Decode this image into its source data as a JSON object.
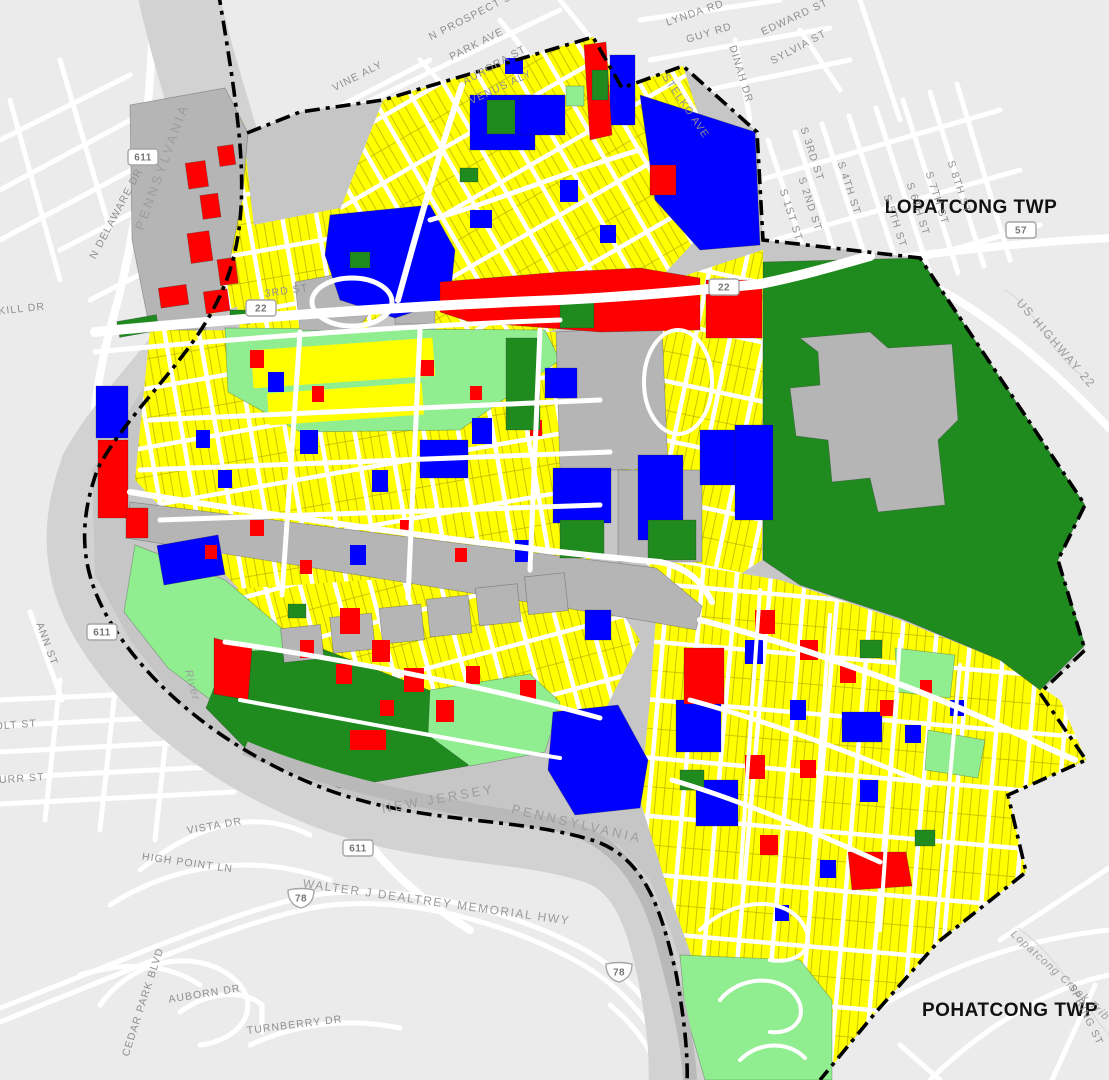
{
  "map": {
    "townships": [
      {
        "t": "LOPATCONG TWP",
        "x": 971,
        "y": 213,
        "r": 0,
        "c": "tw"
      },
      {
        "t": "POHATCONG TWP",
        "x": 1010,
        "y": 1016,
        "r": 0,
        "c": "tw"
      }
    ],
    "state_labels": [
      {
        "t": "PENNSYLVANIA",
        "x": 166,
        "y": 168,
        "r": -70,
        "c": "sta"
      },
      {
        "t": "NEW JERSEY",
        "x": 439,
        "y": 803,
        "r": -10,
        "c": "sta"
      },
      {
        "t": "PENNSYLVANIA",
        "x": 576,
        "y": 828,
        "r": 13,
        "c": "sta"
      }
    ],
    "water_labels": [
      {
        "t": "Lopatcong Creek Trib",
        "x": 1058,
        "y": 978,
        "r": 42,
        "c": "wat"
      },
      {
        "t": "River",
        "x": 189,
        "y": 686,
        "r": 75,
        "c": "wat"
      }
    ],
    "street_labels": [
      {
        "t": "N PROSPECT ST",
        "x": 475,
        "y": 18,
        "r": -27,
        "c": "st"
      },
      {
        "t": "PARK AVE",
        "x": 478,
        "y": 47,
        "r": -27,
        "c": "st"
      },
      {
        "t": "AURORA ST",
        "x": 496,
        "y": 68,
        "r": -29,
        "c": "st"
      },
      {
        "t": "VENUS ALY",
        "x": 502,
        "y": 90,
        "r": -25,
        "c": "st"
      },
      {
        "t": "VINE ALY",
        "x": 359,
        "y": 79,
        "r": -27,
        "c": "st"
      },
      {
        "t": "LYNDA RD",
        "x": 696,
        "y": 16,
        "r": -19,
        "c": "st"
      },
      {
        "t": "GUY RD",
        "x": 710,
        "y": 36,
        "r": -17,
        "c": "st"
      },
      {
        "t": "EDWARD ST",
        "x": 796,
        "y": 20,
        "r": -25,
        "c": "st"
      },
      {
        "t": "SYLVIA ST",
        "x": 800,
        "y": 50,
        "r": -28,
        "c": "st"
      },
      {
        "t": "DINAH DR",
        "x": 738,
        "y": 75,
        "r": 73,
        "c": "st"
      },
      {
        "t": "STELKO AVE",
        "x": 683,
        "y": 108,
        "r": 56,
        "c": "st"
      },
      {
        "t": "S 1ST ST",
        "x": 788,
        "y": 216,
        "r": 72,
        "c": "st"
      },
      {
        "t": "S 2ND ST",
        "x": 807,
        "y": 205,
        "r": 72,
        "c": "st"
      },
      {
        "t": "S 3RD ST",
        "x": 809,
        "y": 155,
        "r": 72,
        "c": "st"
      },
      {
        "t": "S 4TH ST",
        "x": 846,
        "y": 189,
        "r": 72,
        "c": "st"
      },
      {
        "t": "S 5TH ST",
        "x": 892,
        "y": 222,
        "r": 72,
        "c": "st"
      },
      {
        "t": "S 6TH ST",
        "x": 915,
        "y": 210,
        "r": 72,
        "c": "st"
      },
      {
        "t": "S 7TH ST",
        "x": 934,
        "y": 199,
        "r": 72,
        "c": "st"
      },
      {
        "t": "S 8TH ST",
        "x": 956,
        "y": 188,
        "r": 72,
        "c": "st"
      },
      {
        "t": "N DELAWARE DR",
        "x": 119,
        "y": 215,
        "r": -62,
        "c": "st"
      },
      {
        "t": "KILL DR",
        "x": 22,
        "y": 312,
        "r": -6,
        "c": "st"
      },
      {
        "t": "3RD ST",
        "x": 287,
        "y": 294,
        "r": -8,
        "c": "st"
      },
      {
        "t": "ANN ST",
        "x": 44,
        "y": 645,
        "r": 70,
        "c": "st"
      },
      {
        "t": "OLT ST",
        "x": 16,
        "y": 728,
        "r": -4,
        "c": "st"
      },
      {
        "t": "BURR ST",
        "x": 18,
        "y": 782,
        "r": -4,
        "c": "st"
      },
      {
        "t": "VISTA DR",
        "x": 215,
        "y": 829,
        "r": -10,
        "c": "st"
      },
      {
        "t": "HIGH POINT LN",
        "x": 187,
        "y": 866,
        "r": 8,
        "c": "st"
      },
      {
        "t": "WALTER J DEALTREY MEMORIAL HWY",
        "x": 436,
        "y": 906,
        "r": 8,
        "c": "hwy"
      },
      {
        "t": "CEDAR PARK BLVD",
        "x": 146,
        "y": 1003,
        "r": -72,
        "c": "st"
      },
      {
        "t": "AUBORN DR",
        "x": 205,
        "y": 997,
        "r": -9,
        "c": "st"
      },
      {
        "t": "TURNBERRY DR",
        "x": 295,
        "y": 1028,
        "r": -7,
        "c": "st"
      },
      {
        "t": "SPRING ST",
        "x": 1083,
        "y": 1016,
        "r": 64,
        "c": "st"
      },
      {
        "t": "US HIGHWAY 22",
        "x": 1053,
        "y": 346,
        "r": 49,
        "c": "hwy"
      }
    ],
    "shields": [
      {
        "t": "611",
        "x": 143,
        "y": 157,
        "kind": "box"
      },
      {
        "t": "611",
        "x": 102,
        "y": 632,
        "kind": "box"
      },
      {
        "t": "611",
        "x": 358,
        "y": 848,
        "kind": "box"
      },
      {
        "t": "22",
        "x": 261,
        "y": 308,
        "kind": "box"
      },
      {
        "t": "22",
        "x": 724,
        "y": 287,
        "kind": "box"
      },
      {
        "t": "57",
        "x": 1021,
        "y": 230,
        "kind": "box"
      },
      {
        "t": "78",
        "x": 301,
        "y": 898,
        "kind": "interstate"
      },
      {
        "t": "78",
        "x": 619,
        "y": 972,
        "kind": "interstate"
      }
    ],
    "colors": {
      "background": "#ebebeb",
      "road": "#ffffff",
      "river": "#d2d2d2",
      "parcel_yellow": "#ffff00",
      "parcel_blue": "#0000ff",
      "parcel_red": "#ff0000",
      "green_dark": "#1f8b1f",
      "green_light": "#90ee90",
      "parcel_gray": "#b5b5b5",
      "boundary": "#000000",
      "street_label": "#8f8f8f",
      "township_label": "#111111"
    }
  }
}
